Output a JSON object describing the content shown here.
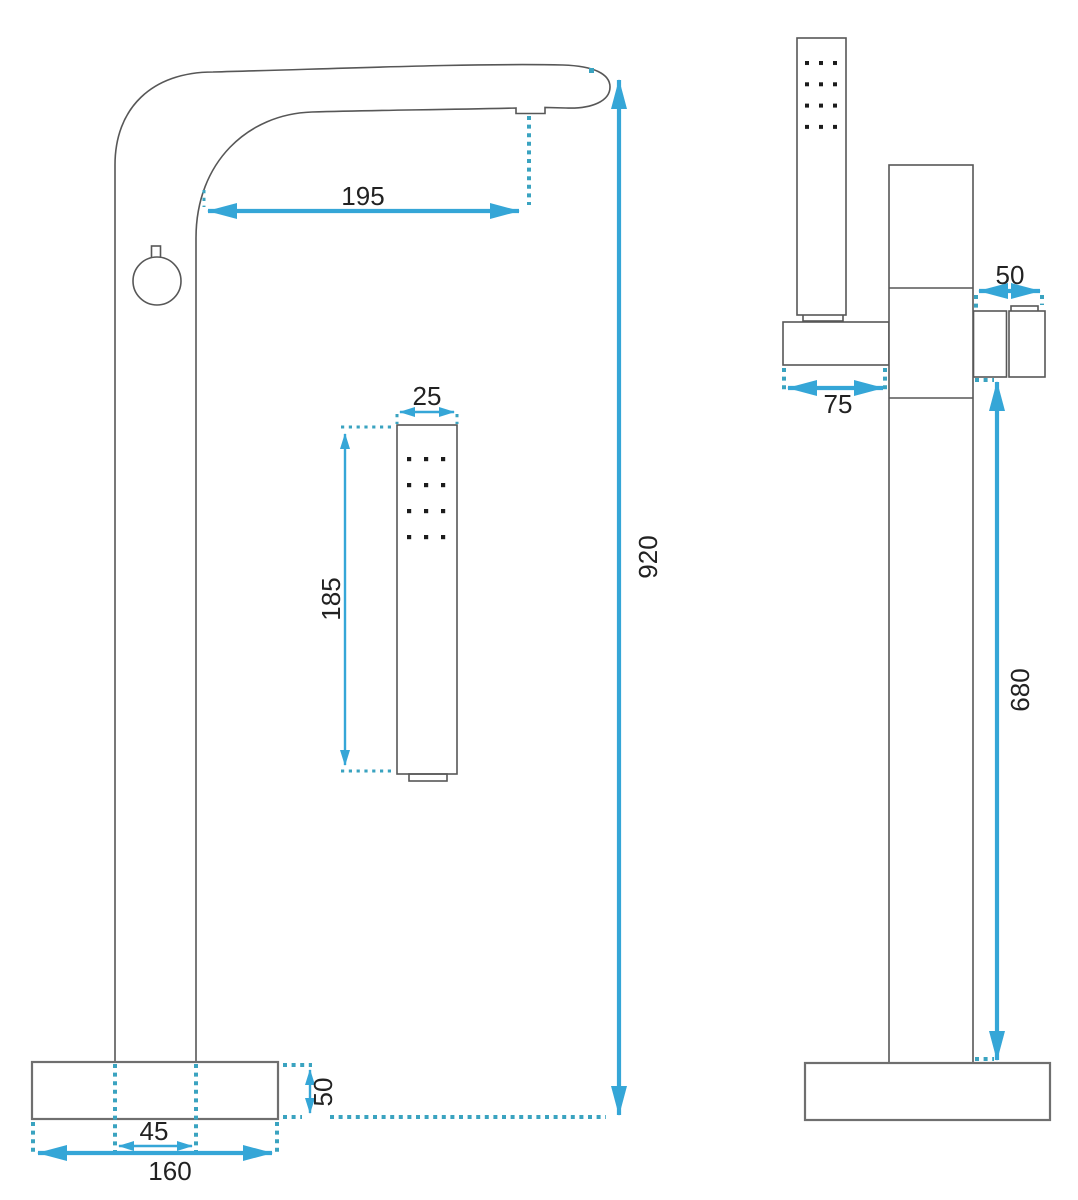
{
  "colors": {
    "dimension_accent": "#35a6d7",
    "dotted_extension": "#3aa3c0",
    "fixture_outline": "#575757",
    "base_outline": "#6f6f6f",
    "text": "#222222",
    "background": "#ffffff"
  },
  "dimensions": {
    "front_view": {
      "spout_reach": "195",
      "overall_height": "920",
      "hand_shower_width": "25",
      "hand_shower_height": "185",
      "base_thickness": "50",
      "column_width": "45",
      "base_width": "160"
    },
    "side_view": {
      "spout_depth": "50",
      "holder_depth": "75",
      "spout_height_above_floor": "680"
    }
  }
}
